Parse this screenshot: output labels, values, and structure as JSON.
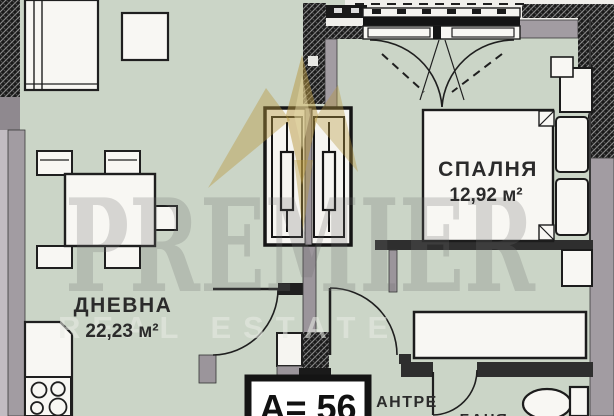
{
  "plan": {
    "apartment_label": "А= 56",
    "rooms": [
      {
        "key": "living",
        "name": "ДНЕВНА",
        "area": "22,23 м²"
      },
      {
        "key": "bedroom",
        "name": "СПАЛНЯ",
        "area": "12,92 м²"
      },
      {
        "key": "hallway",
        "name": "АНТРЕ",
        "area": ""
      },
      {
        "key": "bathroom",
        "name": "БАНЯ",
        "area": ""
      }
    ]
  },
  "watermark": {
    "brand": "PREMIER",
    "tagline": "REAL ESTATE"
  },
  "colors": {
    "floor": "#cbd5c7",
    "wall_gray": "#a29ca2",
    "outline": "#1f1f1f",
    "furniture_white": "#f8f7f3",
    "watermark_gold": "#b7983f",
    "label_ink": "#2b2b2b"
  }
}
